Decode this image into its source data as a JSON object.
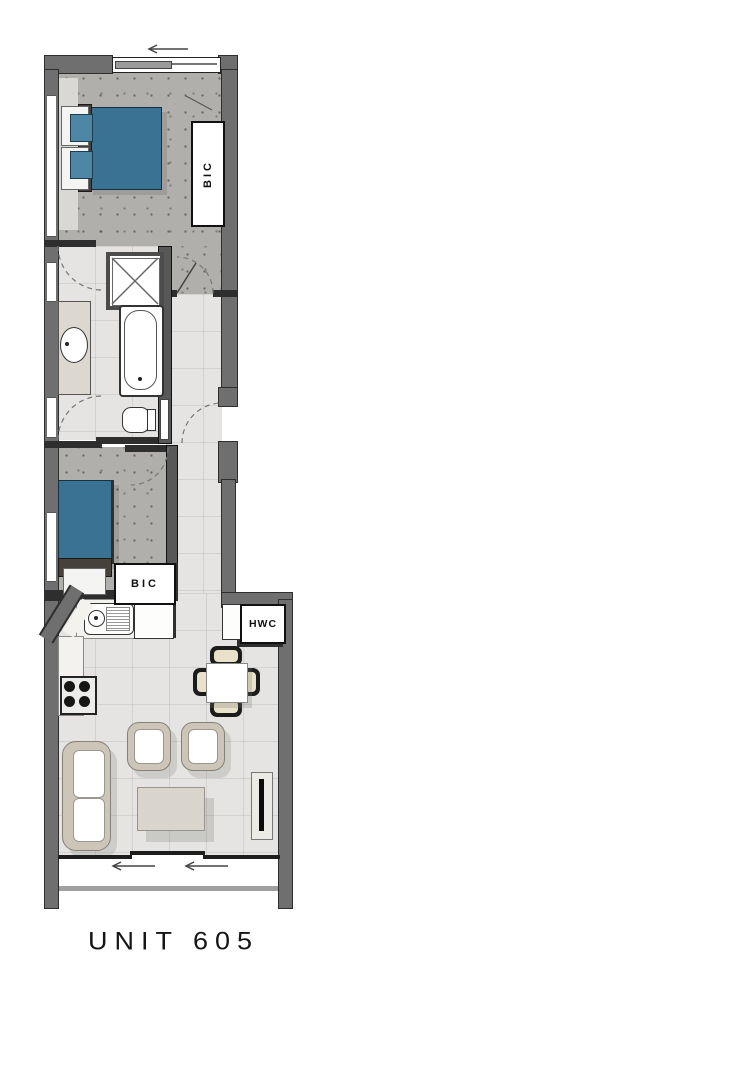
{
  "unit": {
    "label": "UNIT 605"
  },
  "rooms": {
    "main_bedroom": {
      "cupboard_label": "BIC"
    },
    "second_bedroom": {
      "cupboard_label": "BIC"
    },
    "utility": {
      "hot_water_label": "HWC"
    }
  },
  "colors": {
    "wall": "#6f6f6f",
    "bed_blue": "#3a7294",
    "carpet": "#b1afac",
    "tile": "#e5e4e2",
    "counter": "#f3f2ef",
    "furniture_frame": "#cdc6b8",
    "label_ink": "#111111"
  }
}
